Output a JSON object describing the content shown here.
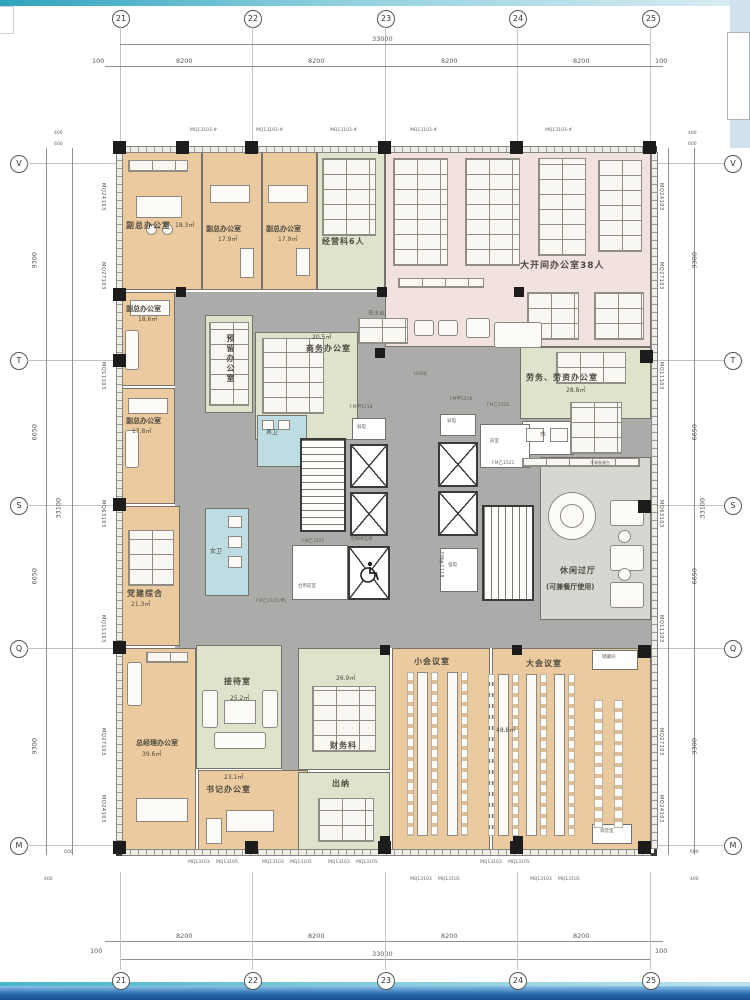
{
  "grid": {
    "top": [
      "21",
      "22",
      "23",
      "24",
      "25"
    ],
    "bottom": [
      "21",
      "22",
      "23",
      "24",
      "25"
    ],
    "left": [
      "V",
      "T",
      "S",
      "Q",
      "M"
    ],
    "right": [
      "V",
      "T",
      "S",
      "Q",
      "M"
    ]
  },
  "dims": {
    "t33000": "33000",
    "t33100": "33100",
    "s8200": "8200",
    "s9300": "9300",
    "s6650": "6650",
    "e100": "100",
    "o600": "600",
    "o400": "400"
  },
  "edge_labels": {
    "mq24": "MQ24103",
    "mq27": "MQ27103",
    "mq11": "MQ11103",
    "mq63": "MQ63103",
    "win_top": "MQ13103-#",
    "win_b1": "MQ13103",
    "win_b2": "MQ13105"
  },
  "rooms": {
    "vz1": {
      "name": "副总办公室",
      "area": "18.3㎡"
    },
    "vz2": {
      "name": "副总办公室",
      "area": "17.9㎡"
    },
    "vz3": {
      "name": "副总办公室",
      "area": "17.9㎡"
    },
    "jyk": {
      "name": "经营科6人"
    },
    "dkj": {
      "name": "大开间办公室38人"
    },
    "vz4": {
      "name": "副总办公室",
      "area": "18.6㎡"
    },
    "vz5": {
      "name": "副总办公室",
      "area": "17.8㎡"
    },
    "djzh": {
      "name": "党建综合",
      "area": "21.3㎡"
    },
    "yl": {
      "name": "预留办公室"
    },
    "sw": {
      "name": "商务办公室",
      "area": "20.5㎡"
    },
    "lw": {
      "name": "劳务、劳资办公室",
      "area": "28.8㎡"
    },
    "xx": {
      "name": "休闲过厅",
      "note": "(可兼餐厅使用)"
    },
    "jd": {
      "name": "接待室",
      "area": "25.2㎡"
    },
    "zjl": {
      "name": "总经理办公室",
      "area": "39.6㎡"
    },
    "sj": {
      "name": "书记办公室",
      "area": "23.1㎡"
    },
    "cw": {
      "name": "财务科",
      "area": "26.9㎡"
    },
    "cn": {
      "name": "出纳"
    },
    "xhy": {
      "name": "小会议室"
    },
    "dhy": {
      "name": "大会议室",
      "area": "48.8㎡"
    },
    "ccj": {
      "name": "储藏间"
    },
    "tyj": {
      "name": "调音室"
    },
    "nw": {
      "name": "男卫"
    },
    "nvw": {
      "name": "女卫"
    }
  },
  "core": {
    "rd": "弱电",
    "qd": "强电",
    "qs": "前室",
    "hyqs": "合用前室",
    "wza": "无障碍电梯",
    "shui": "水",
    "cst": "茶水台",
    "lc": "冷餐备餐台",
    "gn": "1000高"
  },
  "doors": {
    "a": "FM乙1521",
    "b": "FM乙1521(甲)",
    "c": "FM甲1218",
    "d": "FM甲1118"
  }
}
